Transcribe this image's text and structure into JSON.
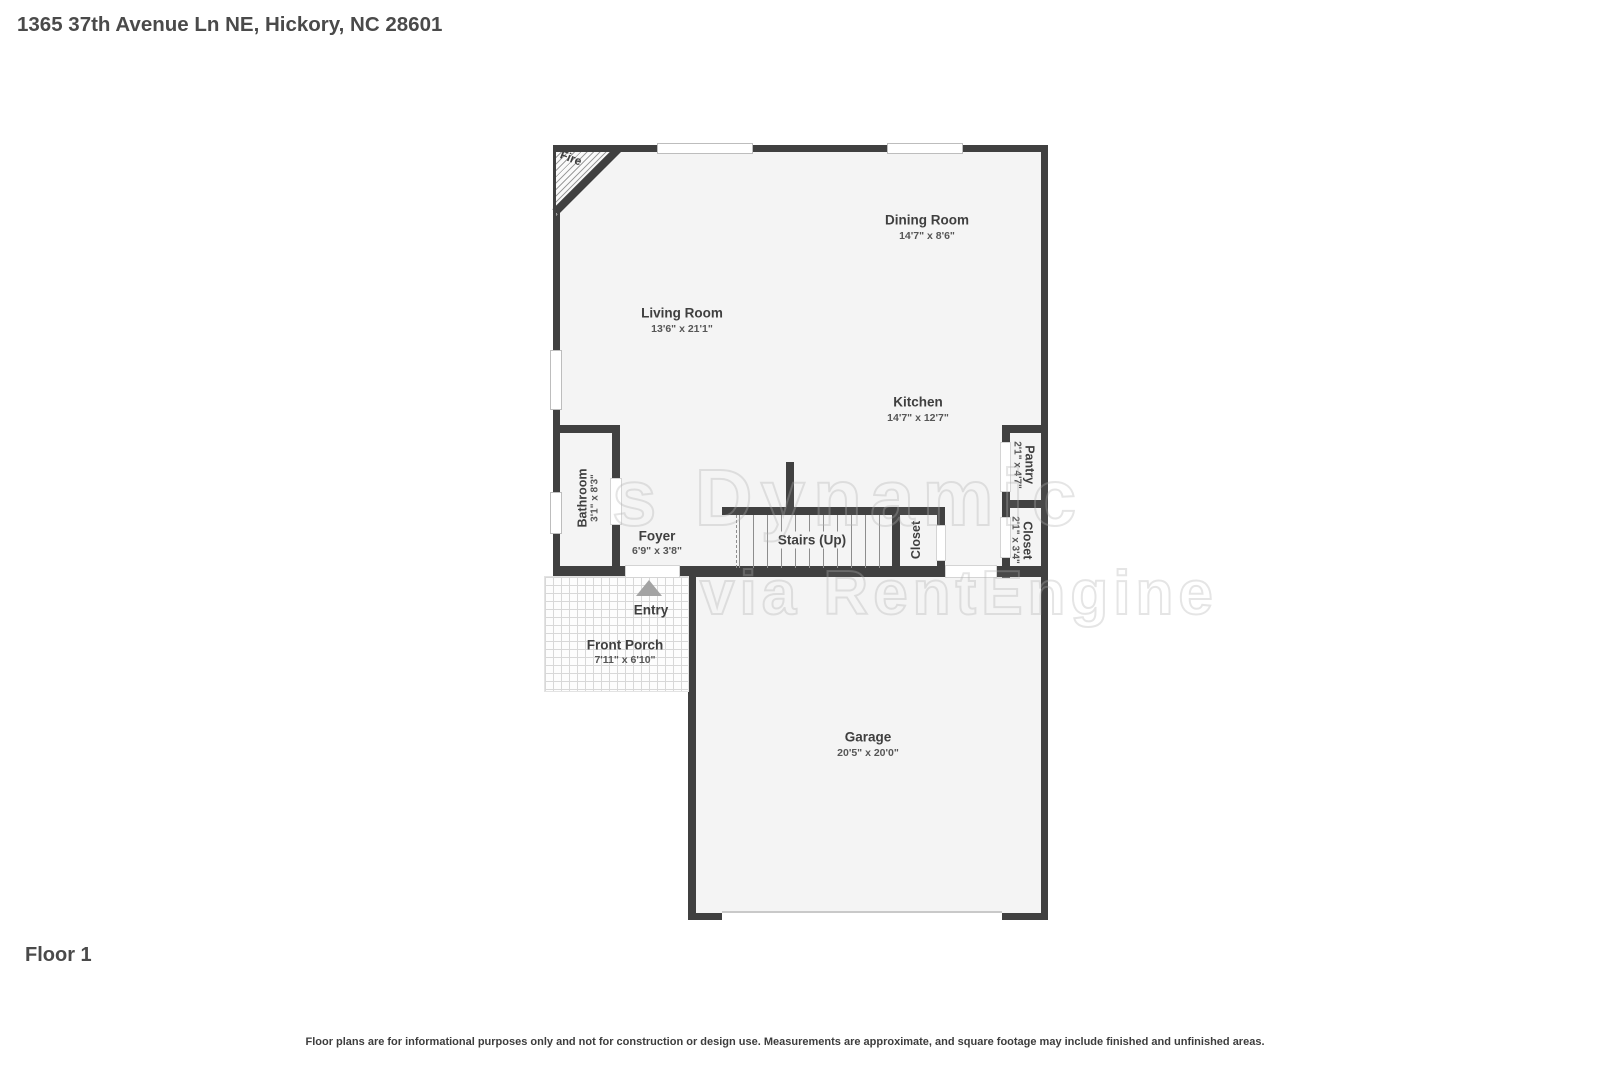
{
  "header": {
    "title": "1365 37th Avenue Ln NE, Hickory, NC 28601"
  },
  "footer": {
    "floor_label": "Floor 1",
    "disclaimer": "Floor plans are for informational purposes only and not for construction or design use. Measurements are approximate, and square footage may include finished and unfinished areas."
  },
  "watermark": {
    "line1": "s Dynamic",
    "line2": "via RentEngine"
  },
  "colors": {
    "wall": "#404040",
    "floor": "#f4f4f4",
    "text": "#4a4a4a",
    "watermark": "#b0b0b0",
    "entry_arrow": "#a3a3a3"
  },
  "rooms": {
    "dining_room": {
      "name": "Dining Room",
      "dims": "14'7\" x 8'6\""
    },
    "living_room": {
      "name": "Living Room",
      "dims": "13'6\" x 21'1\""
    },
    "kitchen": {
      "name": "Kitchen",
      "dims": "14'7\" x 12'7\""
    },
    "bathroom": {
      "name": "Bathroom",
      "dims": "3'1\" x 8'3\""
    },
    "foyer": {
      "name": "Foyer",
      "dims": "6'9\" x 3'8\""
    },
    "stairs": {
      "name": "Stairs (Up)"
    },
    "stairs_closet": {
      "name": "Closet"
    },
    "pantry": {
      "name": "Pantry",
      "dims": "2'1\" x 4'7\""
    },
    "hall_closet": {
      "name": "Closet",
      "dims": "2'1\" x 3'4\""
    },
    "entry": {
      "name": "Entry"
    },
    "front_porch": {
      "name": "Front Porch",
      "dims": "7'11\" x 6'10\""
    },
    "garage": {
      "name": "Garage",
      "dims": "20'5\" x 20'0\""
    },
    "fireplace": {
      "name": "Fire"
    }
  }
}
